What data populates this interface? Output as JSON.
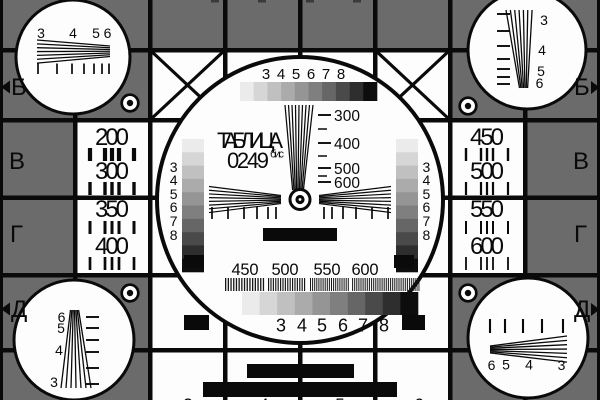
{
  "card": {
    "name": "ТАБЛИЦА",
    "number": "0249",
    "number_suffix": "бис"
  },
  "colors": {
    "background_gray": "#6b6b6b",
    "surface_white": "#fdfdfd",
    "line_black": "#0a0a0a",
    "grayscale_ramp": [
      "#ebebeb",
      "#d6d6d6",
      "#c0c0c0",
      "#ababab",
      "#959595",
      "#7f7f7f",
      "#666666",
      "#4a4a4a",
      "#2e2e2e",
      "#0d0d0d"
    ]
  },
  "row_markers": {
    "left": [
      "Б",
      "В",
      "Г",
      "Д"
    ],
    "right": [
      "Б",
      "В",
      "Г",
      "Д"
    ]
  },
  "resolution_panels": {
    "left": [
      "200",
      "300",
      "350",
      "400"
    ],
    "right": [
      "450",
      "500",
      "550",
      "600"
    ]
  },
  "center_circle": {
    "grayscale_top_labels": [
      "3",
      "4",
      "5",
      "6",
      "7",
      "8"
    ],
    "vertical_wedge_labels": [
      "300",
      "400",
      "500",
      "600"
    ],
    "bottom_frequency_labels": [
      "450",
      "500",
      "550",
      "600"
    ],
    "grayscale_bottom_labels": [
      "3",
      "4",
      "5",
      "6",
      "7",
      "8"
    ]
  },
  "corner_circles": {
    "top_left_labels": [
      "3",
      "4",
      "5",
      "6"
    ],
    "top_right_labels": [
      "3",
      "4",
      "5",
      "6"
    ],
    "bottom_left_labels": [
      "6",
      "5",
      "4",
      "3"
    ],
    "bottom_right_labels": [
      "6",
      "5",
      "4",
      "3"
    ]
  },
  "cropped_edge_digits": {
    "bottom": [
      "3",
      "4",
      "5",
      "6"
    ]
  }
}
